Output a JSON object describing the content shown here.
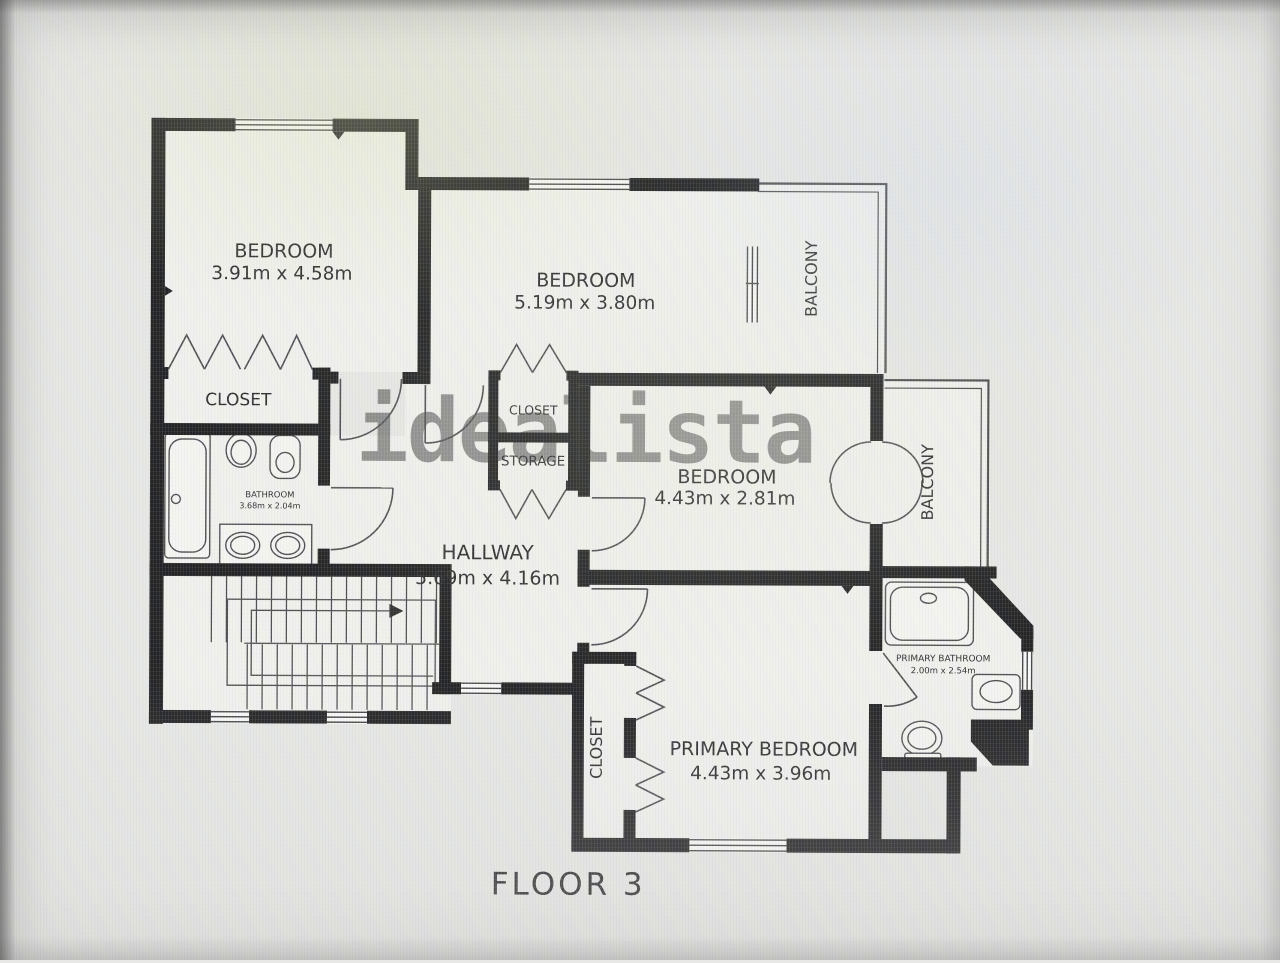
{
  "watermark": "idealista",
  "floor_label": "FLOOR 3",
  "rooms": {
    "bedroom_top_left": {
      "name": "BEDROOM",
      "dims": "3.91m x 4.58m"
    },
    "bedroom_top_middle": {
      "name": "BEDROOM",
      "dims": "5.19m x 3.80m"
    },
    "bedroom_middle_right": {
      "name": "BEDROOM",
      "dims": "4.43m x 2.81m"
    },
    "primary_bedroom": {
      "name": "PRIMARY BEDROOM",
      "dims": "4.43m x 3.96m"
    },
    "hallway": {
      "name": "HALLWAY",
      "dims": "5.69m x 4.16m"
    },
    "bathroom": {
      "name": "BATHROOM",
      "dims": "3.68m x 2.04m"
    },
    "primary_bathroom": {
      "name": "PRIMARY BATHROOM",
      "dims": "2.00m x 2.54m"
    },
    "closet_top_left": {
      "label": "CLOSET"
    },
    "closet_middle": {
      "label": "CLOSET"
    },
    "storage": {
      "label": "STORAGE"
    },
    "closet_primary": {
      "label": "CLOSET"
    },
    "balcony_top": {
      "label": "BALCONY"
    },
    "balcony_right": {
      "label": "BALCONY"
    }
  },
  "colors": {
    "wall": "#1c1c1e",
    "line": "#4a4a4e",
    "paper": "#e8e8e6",
    "room": "#f2f2ef"
  }
}
